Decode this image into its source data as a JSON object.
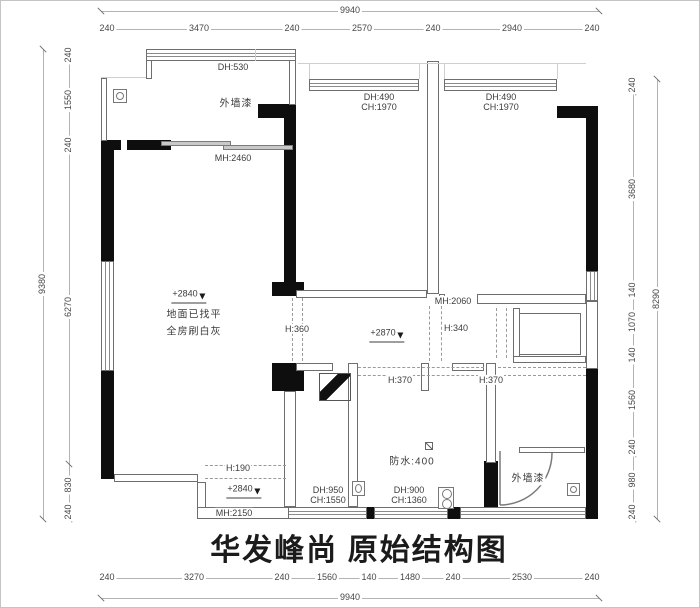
{
  "title": "华发峰尚 原始结构图",
  "colors": {
    "wall": "#0e0e0e",
    "line": "#6e6e6e",
    "dim_text": "#474747"
  },
  "dims": {
    "top": {
      "overall": "9940",
      "segments": [
        "240",
        "3470",
        "240",
        "2570",
        "240",
        "2940",
        "240"
      ]
    },
    "left": {
      "overall": "9380",
      "segments": [
        "240",
        "1550",
        "240",
        "6270",
        "830",
        "240"
      ]
    },
    "right": {
      "overall": "8290",
      "segments": [
        "240",
        "3680",
        "140",
        "1070",
        "140",
        "1560",
        "240",
        "980",
        "240"
      ]
    },
    "bottom": {
      "overall": "9940",
      "segments": [
        "240",
        "3270",
        "240",
        "1560",
        "140",
        "1480",
        "240",
        "2530",
        "240"
      ]
    }
  },
  "labels": {
    "balcony_window": "DH:530",
    "balcony_paint": "外墙漆",
    "balcony_door": "MH:2460",
    "bed2_window_dh": "DH:490",
    "bed2_window_ch": "CH:1970",
    "bed1_window_dh": "DH:490",
    "bed1_window_ch": "CH:1970",
    "living_level": "+2840",
    "living_note1": "地面已找平",
    "living_note2": "全房刷白灰",
    "opening_h360": "H:360",
    "hall_level": "+2870",
    "hall_door": "MH:2060",
    "beam_h340": "H:340",
    "beam_h370_left": "H:370",
    "beam_h370_right": "H:370",
    "waterproof": "防水:400",
    "bath_window_dh": "DH:950",
    "bath_window_ch": "CH:1550",
    "laundry_window_dh": "DH:900",
    "laundry_window_ch": "CH:1360",
    "terrace_paint": "外墙漆",
    "entry_beam": "H:190",
    "entry_level": "+2840",
    "entry_door": "MH:2150"
  }
}
